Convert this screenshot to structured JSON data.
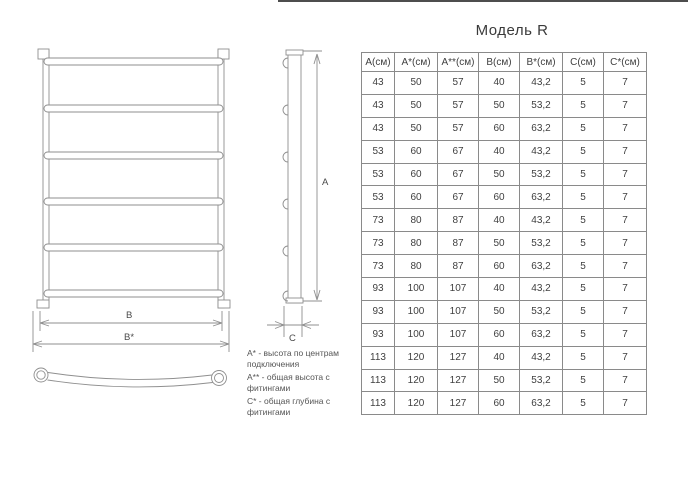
{
  "page": {
    "title": "Модель R"
  },
  "table": {
    "columns": [
      "А(см)",
      "А*(см)",
      "А**(см)",
      "В(см)",
      "В*(см)",
      "С(см)",
      "С*(см)"
    ],
    "rows": [
      [
        "43",
        "50",
        "57",
        "40",
        "43,2",
        "5",
        "7"
      ],
      [
        "43",
        "50",
        "57",
        "50",
        "53,2",
        "5",
        "7"
      ],
      [
        "43",
        "50",
        "57",
        "60",
        "63,2",
        "5",
        "7"
      ],
      [
        "53",
        "60",
        "67",
        "40",
        "43,2",
        "5",
        "7"
      ],
      [
        "53",
        "60",
        "67",
        "50",
        "53,2",
        "5",
        "7"
      ],
      [
        "53",
        "60",
        "67",
        "60",
        "63,2",
        "5",
        "7"
      ],
      [
        "73",
        "80",
        "87",
        "40",
        "43,2",
        "5",
        "7"
      ],
      [
        "73",
        "80",
        "87",
        "50",
        "53,2",
        "5",
        "7"
      ],
      [
        "73",
        "80",
        "87",
        "60",
        "63,2",
        "5",
        "7"
      ],
      [
        "93",
        "100",
        "107",
        "40",
        "43,2",
        "5",
        "7"
      ],
      [
        "93",
        "100",
        "107",
        "50",
        "53,2",
        "5",
        "7"
      ],
      [
        "93",
        "100",
        "107",
        "60",
        "63,2",
        "5",
        "7"
      ],
      [
        "113",
        "120",
        "127",
        "40",
        "43,2",
        "5",
        "7"
      ],
      [
        "113",
        "120",
        "127",
        "50",
        "53,2",
        "5",
        "7"
      ],
      [
        "113",
        "120",
        "127",
        "60",
        "63,2",
        "5",
        "7"
      ]
    ]
  },
  "drawing": {
    "labels": {
      "height": "А",
      "width_inner": "В",
      "width_outer": "В*",
      "depth": "С"
    }
  },
  "legend": {
    "items": [
      "А* - высота по центрам подключения",
      "А** - общая высота с фитингами",
      "С* - общая глубина с фитингами"
    ]
  },
  "colors": {
    "line": "#8f8f8f",
    "table_border": "#8a8a8a",
    "text": "#3f3f3f",
    "background": "#ffffff"
  }
}
